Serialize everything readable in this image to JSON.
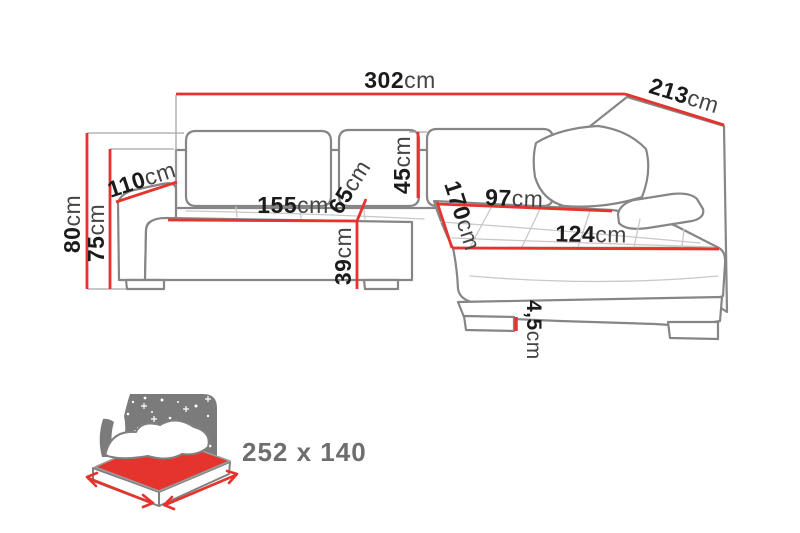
{
  "diagram_title": "corner-sofa-dimensions",
  "colors": {
    "background": "#ffffff",
    "dimension_red": "#e5332d",
    "outline_grey": "#868686",
    "number_black": "#1b1b1b",
    "unit_grey": "#454545",
    "bed_icon_grey": "#7b7b7b",
    "sleep_text_grey": "#6e6e6e"
  },
  "dimensions": {
    "total_width": {
      "num": "302",
      "unit": "cm"
    },
    "total_depth": {
      "num": "213",
      "unit": "cm"
    },
    "back_height": {
      "num": "80",
      "unit": "cm"
    },
    "armrest_height": {
      "num": "75",
      "unit": "cm"
    },
    "armrest_depth": {
      "num": "110",
      "unit": "cm"
    },
    "seat_width": {
      "num": "155",
      "unit": "cm"
    },
    "seat_depth": {
      "num": "65",
      "unit": "cm"
    },
    "back_cushion_height": {
      "num": "45",
      "unit": "cm"
    },
    "seat_height": {
      "num": "39",
      "unit": "cm"
    },
    "chaise_length": {
      "num": "170",
      "unit": "cm"
    },
    "chaise_back_width": {
      "num": "97",
      "unit": "cm"
    },
    "chaise_front_width": {
      "num": "124",
      "unit": "cm"
    },
    "leg_height": {
      "num": "4,5",
      "unit": "cm"
    }
  },
  "sleeping_area": {
    "size": "252 x 140"
  }
}
